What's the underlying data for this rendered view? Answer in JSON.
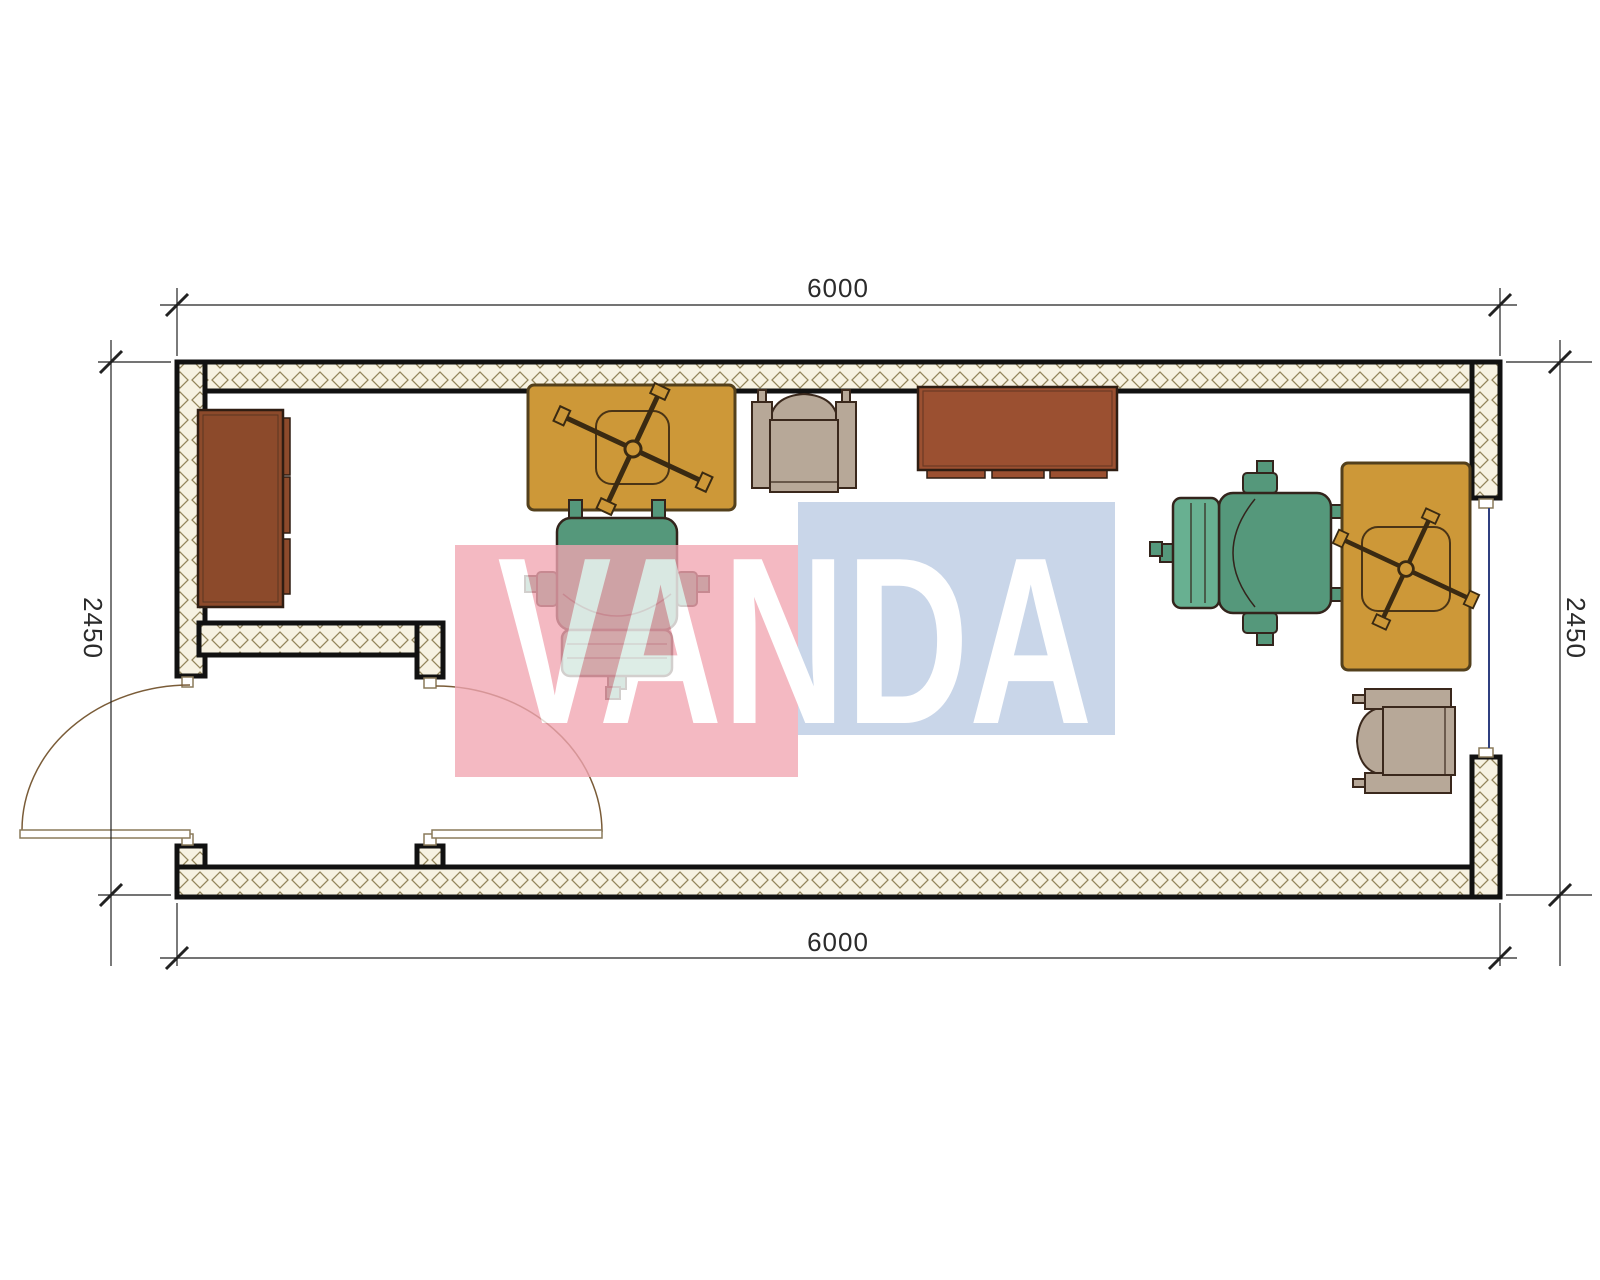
{
  "drawing": {
    "type": "floor-plan-top-view",
    "dims": {
      "top": "6000",
      "bottom": "6000",
      "left": "2450",
      "right": "2450"
    },
    "watermark": {
      "text": "VANDA",
      "pink_color": "#F1A6B2",
      "blue_color": "#BACBE3",
      "text_color": "#FFFFFF"
    },
    "colors": {
      "wall_outline": "#111111",
      "wall_hatch_bg": "#F7F2E2",
      "wall_hatch_line": "#94865C",
      "desk": "#CD9838",
      "cabinet_left": "#8C4A2B",
      "cabinet_top": "#9B5031",
      "office_chair": "#55987B",
      "armchair": "#B7A898",
      "window_glazing": "#2F3F7F",
      "door_swing": "#7A5C38",
      "dimension_line": "#222222"
    },
    "furniture": [
      "wardrobe-cabinet-left",
      "desk-left-with-cross-base",
      "armchair-top",
      "credenza-top-center",
      "office-chair-left",
      "office-chair-right",
      "desk-right-with-cross-base",
      "armchair-bottom-right"
    ],
    "openings": [
      "entry-door-left-wall",
      "interior-door-vestibule",
      "window-right-wall"
    ]
  }
}
